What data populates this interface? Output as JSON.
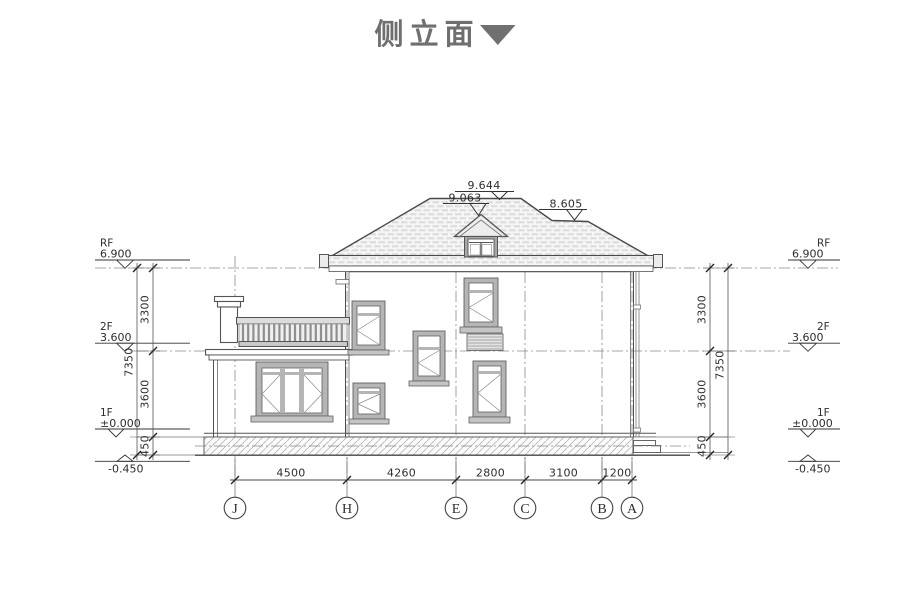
{
  "title": {
    "label": "侧立面"
  },
  "roof_elevations": {
    "ridge": "9.644",
    "dormer": "9.063",
    "side": "8.605"
  },
  "levels": {
    "rf": {
      "name": "RF",
      "value": "6.900"
    },
    "f2": {
      "name": "2F",
      "value": "3.600"
    },
    "f1": {
      "name": "1F",
      "value": "±0.000"
    },
    "ground": {
      "value": "-0.450"
    }
  },
  "vertical_dims": {
    "upper": "3300",
    "lower": "3600",
    "plinth": "450",
    "total": "7350"
  },
  "horizontal_dims": {
    "j_h": "4500",
    "h_e": "4260",
    "e_c": "2800",
    "c_b": "3100",
    "b_a": "1200"
  },
  "grid_axes": [
    "J",
    "H",
    "E",
    "C",
    "B",
    "A"
  ]
}
